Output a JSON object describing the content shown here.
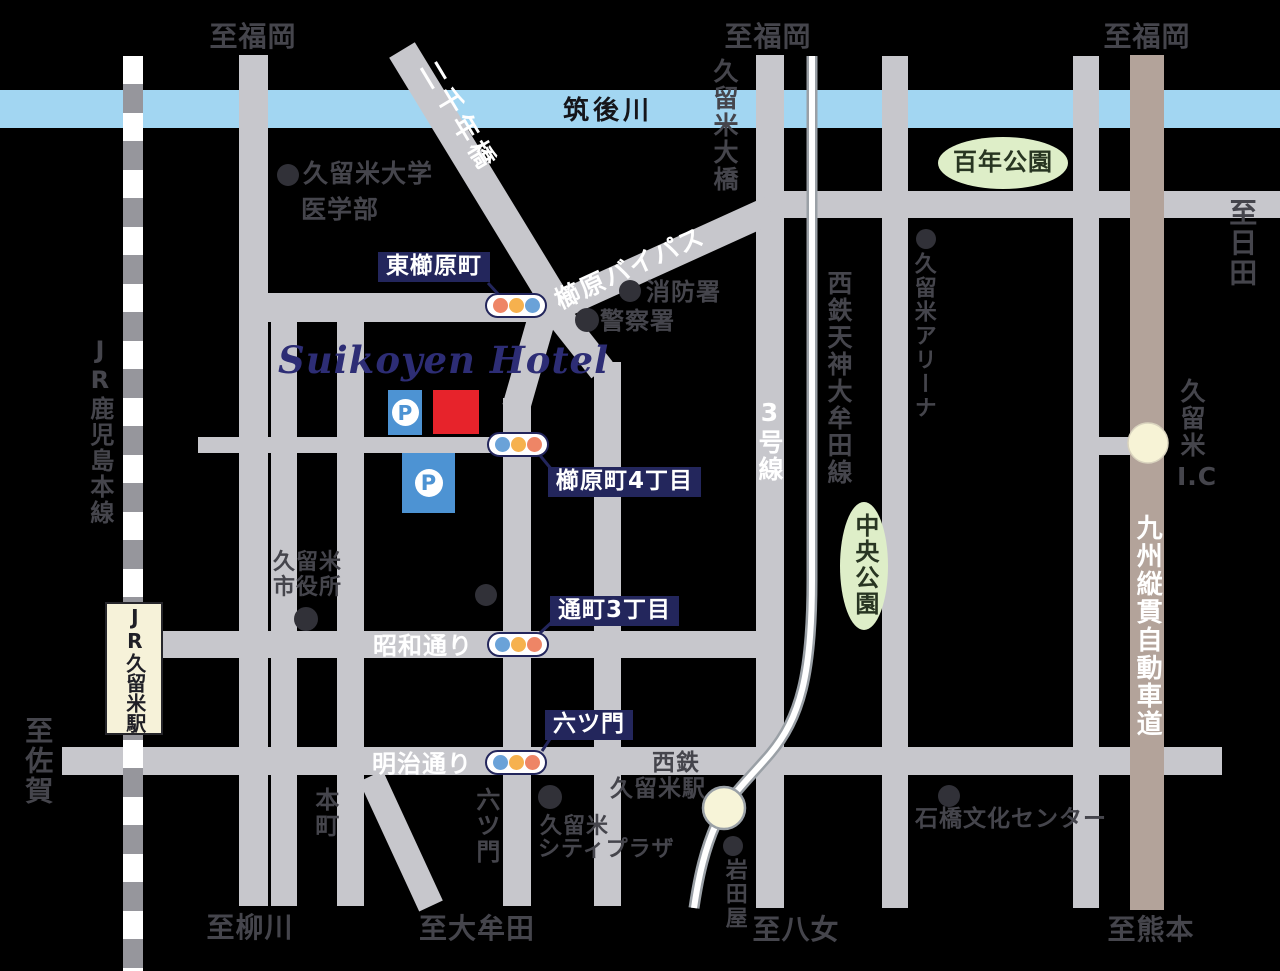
{
  "title": "Suikoyen Hotel access map",
  "colors": {
    "background": "#000000",
    "road_gray": "#c7c7cc",
    "expressway_brown": "#b3a39a",
    "river_blue": "#a2d6f2",
    "park_green": "#deeec8",
    "label_navy": "#23265c",
    "hotel_red": "#e7232b",
    "parking_blue": "#4d93d3",
    "station_cream": "#f6f2d9",
    "signal_blue": "#6aa2d8",
    "signal_orange": "#f6b14e",
    "signal_salmon": "#ee8566"
  },
  "hotel": {
    "name": "Suikoyen Hotel",
    "parking_label": "P"
  },
  "river": {
    "name": "筑後川"
  },
  "edges": {
    "fukuoka_1": "至福岡",
    "fukuoka_2": "至福岡",
    "fukuoka_3": "至福岡",
    "hita": "至日田",
    "saga": "至佐賀",
    "yanagawa": "至柳川",
    "omuta": "至大牟田",
    "yame": "至八女",
    "kumamoto": "至熊本"
  },
  "roads": {
    "bridge_2000": "二千年橋",
    "kushihara_bypass": "櫛原バイパス",
    "kurume_ohashi": "久留米大橋",
    "route3": "3号線",
    "nishitetsu_line": "西鉄天神大牟田線",
    "kyushu_expressway": "九州縦貫自動車道",
    "jr_kagoshima_line": "JR鹿児島本線",
    "showa_street": "昭和通り",
    "meiji_street": "明治通り"
  },
  "parks": {
    "hyakunen": "百年公園",
    "chuo": "中央公園"
  },
  "signals": [
    {
      "label": "東櫛原町"
    },
    {
      "label": "櫛原町4丁目"
    },
    {
      "label": "通町3丁目"
    },
    {
      "label": "六ツ門"
    }
  ],
  "pois": {
    "university_l1": "久留米大学",
    "university_l2": "医学部",
    "fire_station": "消防署",
    "police_station": "警察署",
    "city_hall_l1": "久留米",
    "city_hall_l2": "市役所",
    "arena": "久留米アリーナ",
    "city_plaza_l1": "久留米",
    "city_plaza_l2": "シティプラザ",
    "iwataya": "岩田屋",
    "ishibashi_center": "石橋文化センター",
    "honmachi": "本町",
    "mutsumon_street": "六ツ門",
    "nishitetsu_sta_l1": "西鉄",
    "nishitetsu_sta_l2": "久留米駅",
    "jr_station": "JR久留米駅",
    "ic_kanji": "久留米",
    "ic_suffix": "I.C"
  }
}
